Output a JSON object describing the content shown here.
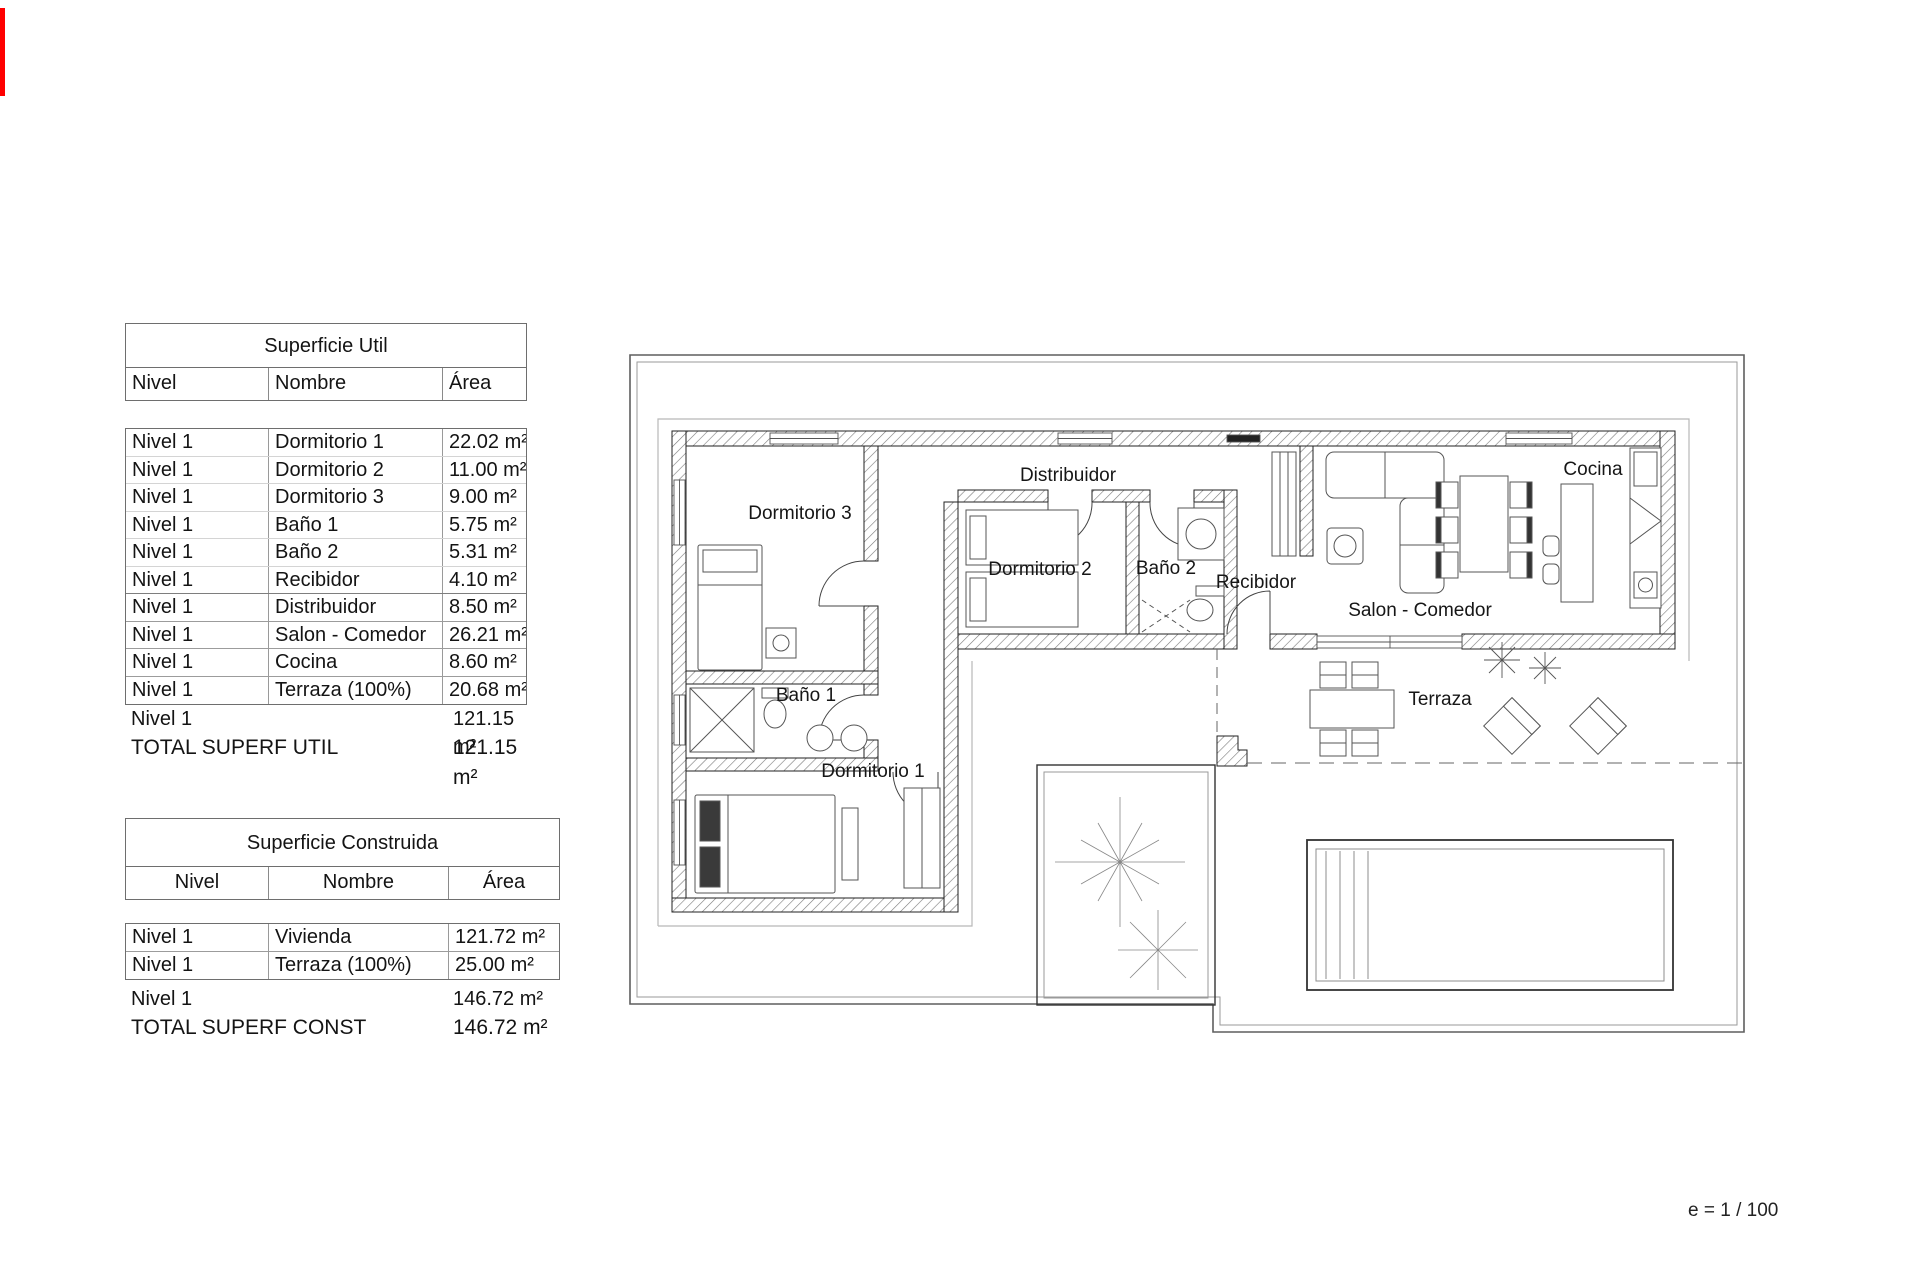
{
  "tables": {
    "util": {
      "title": "Superficie Util",
      "columns": [
        "Nivel",
        "Nombre",
        "Área"
      ],
      "rows": [
        {
          "nivel": "Nivel 1",
          "nombre": "Dormitorio 1",
          "area": "22.02 m²"
        },
        {
          "nivel": "Nivel 1",
          "nombre": "Dormitorio 2",
          "area": "11.00 m²"
        },
        {
          "nivel": "Nivel 1",
          "nombre": "Dormitorio 3",
          "area": "9.00 m²"
        },
        {
          "nivel": "Nivel 1",
          "nombre": "Baño 1",
          "area": "5.75 m²"
        },
        {
          "nivel": "Nivel 1",
          "nombre": "Baño 2",
          "area": "5.31 m²"
        },
        {
          "nivel": "Nivel 1",
          "nombre": "Recibidor",
          "area": "4.10 m²"
        },
        {
          "nivel": "Nivel 1",
          "nombre": "Distribuidor",
          "area": "8.50 m²"
        },
        {
          "nivel": "Nivel 1",
          "nombre": "Salon - Comedor",
          "area": "26.21 m²"
        },
        {
          "nivel": "Nivel 1",
          "nombre": "Cocina",
          "area": "8.60 m²"
        },
        {
          "nivel": "Nivel 1",
          "nombre": "Terraza (100%)",
          "area": "20.68 m²"
        }
      ],
      "subtotal_label": "Nivel 1",
      "subtotal_area": "121.15 m²",
      "total_label": "TOTAL SUPERF UTIL",
      "total_area": "121.15 m²"
    },
    "construida": {
      "title": "Superficie Construida",
      "columns": [
        "Nivel",
        "Nombre",
        "Área"
      ],
      "rows": [
        {
          "nivel": "Nivel 1",
          "nombre": "Vivienda",
          "area": "121.72 m²"
        },
        {
          "nivel": "Nivel 1",
          "nombre": "Terraza (100%)",
          "area": "25.00 m²"
        }
      ],
      "subtotal_label": "Nivel 1",
      "subtotal_area": "146.72 m²",
      "total_label": "TOTAL SUPERF CONST",
      "total_area": "146.72 m²"
    }
  },
  "plan": {
    "rooms": {
      "dormitorio1": "Dormitorio 1",
      "dormitorio2": "Dormitorio 2",
      "dormitorio3": "Dormitorio 3",
      "bano1": "Baño 1",
      "bano2": "Baño 2",
      "recibidor": "Recibidor",
      "distribuidor": "Distribuidor",
      "salon": "Salon - Comedor",
      "cocina": "Cocina",
      "terraza": "Terraza"
    },
    "scale_label": "e = 1 / 100"
  }
}
